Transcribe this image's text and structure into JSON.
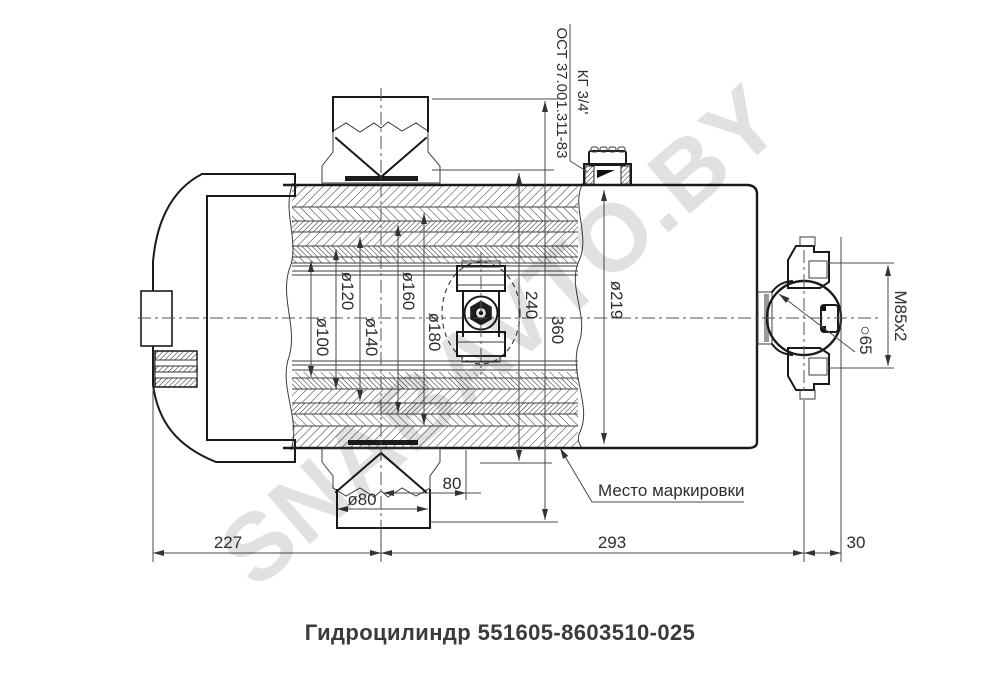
{
  "title": "Гидроцилиндр 551605-8603510-025",
  "watermark": "SNABAVTO.BY",
  "annotations": {
    "port_thread": "КГ 3/4'",
    "port_standard": "ОСТ 37.001.311-83",
    "marking_note": "Место маркировки"
  },
  "dimensions": {
    "bore_seals": [
      "ø100",
      "ø120",
      "ø140",
      "ø160",
      "ø180"
    ],
    "barrel_od": "ø219",
    "height_240": "240",
    "height_360": "360",
    "boss_dia": "ø80",
    "offset_80": "80",
    "rod_thread": "M85x2",
    "ball_sphere": "○65",
    "len_left": "227",
    "len_mid": "293",
    "len_right": "30"
  },
  "colors": {
    "line": "#1a1a1a",
    "dim_line": "#4a4a4a",
    "watermark": "#bdbdbd",
    "title_text": "#3a3a3a",
    "background": "#ffffff"
  }
}
